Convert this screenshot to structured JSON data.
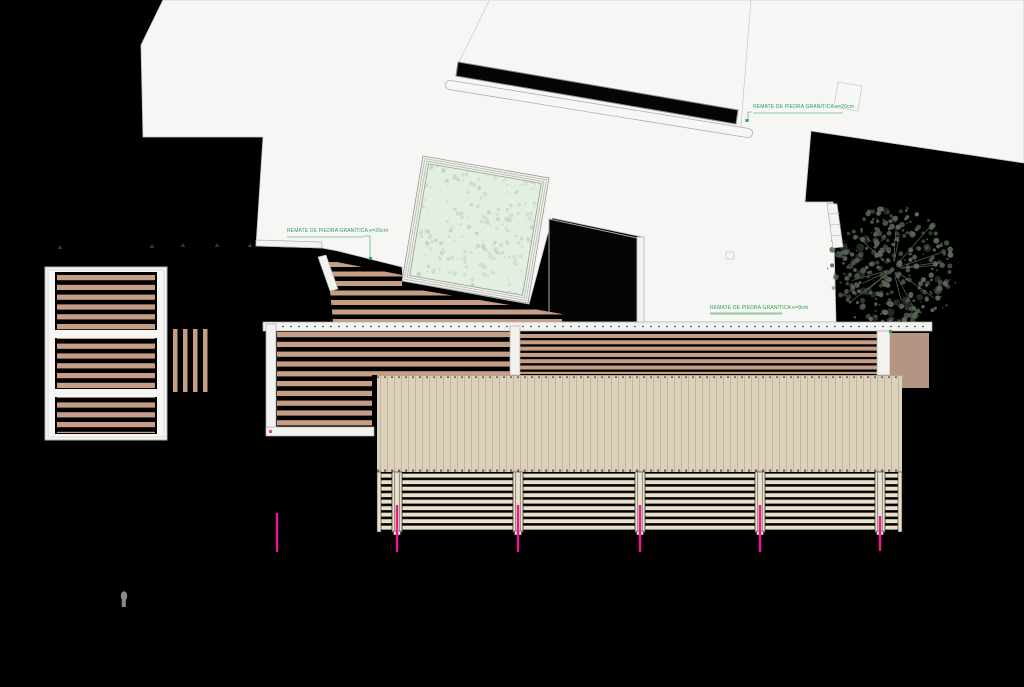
{
  "canvas": {
    "width": 1024,
    "height": 687,
    "background": "#000000"
  },
  "palette": {
    "paper": "#f6f6f4",
    "paper_line": "#c6c6c6",
    "line_dark": "#9a9a93",
    "plank": "#c69d85",
    "roof_base": "#ddd1bc",
    "roof_stripe": "#c3b59b",
    "roof_tick": "#6a6358",
    "louver": "#e9e1cc",
    "louver_line": "#35302a",
    "pool_frame": "#f0f0ea",
    "pool_ring": "#b0b0aa",
    "pool_water": "#e3efe2",
    "pool_speckle1": "#b9d2b6",
    "pool_speckle2": "#a6c4a3",
    "pool_edge": "#8ba08a",
    "tree": "#5a6a57",
    "annotation_green": "#2f9e4e",
    "section_pink": "#f01590",
    "solid_brown": "#b49483",
    "figure_gray": "#8a8a8a",
    "marker_dark": "#3a3a3a",
    "kerb_fill": "#f2f2ee",
    "kerb_line": "#b0b0b0",
    "void_black": "#050505"
  },
  "annotations": [
    {
      "text": "REMATE DE PIEDRA GRANÍTICA e=20cm",
      "x": 753,
      "y": 105
    },
    {
      "text": "REMATE DE PIEDRA GRANÍTICA e=20cm",
      "x": 287,
      "y": 229
    },
    {
      "text": "REMATE DE PIEDRA GRANÍTICA e=8cm",
      "x": 710,
      "y": 306
    }
  ],
  "terrain": {
    "points": [
      [
        163,
        0
      ],
      [
        1024,
        0
      ],
      [
        1024,
        163
      ],
      [
        811,
        131
      ],
      [
        805,
        202
      ],
      [
        833,
        202
      ],
      [
        836,
        322
      ],
      [
        643,
        322
      ],
      [
        643,
        237
      ],
      [
        552,
        218
      ],
      [
        529,
        304
      ],
      [
        403,
        281
      ],
      [
        402,
        267
      ],
      [
        338,
        251
      ],
      [
        322,
        248
      ],
      [
        256,
        246
      ],
      [
        263,
        137
      ],
      [
        143,
        137
      ],
      [
        141,
        45
      ]
    ]
  },
  "details": {
    "faint_lines": [
      [
        751,
        0,
        740,
        137
      ],
      [
        489,
        1,
        459,
        62
      ]
    ],
    "small_squares": [
      {
        "points": [
          [
            838,
            82
          ],
          [
            862,
            86
          ],
          [
            858,
            111
          ],
          [
            834,
            107
          ]
        ]
      },
      {
        "points": [
          [
            726,
            252
          ],
          [
            734,
            252
          ],
          [
            734,
            259
          ],
          [
            726,
            259
          ]
        ]
      }
    ],
    "stadium": {
      "x1": 450,
      "y1": 85,
      "x2": 748,
      "y2": 133
    }
  },
  "black_overlays": [
    {
      "name": "wall-band",
      "points": [
        [
          458,
          62
        ],
        [
          738,
          110
        ],
        [
          736,
          124
        ],
        [
          456,
          76
        ]
      ],
      "stroke": "#8a8a8a"
    },
    {
      "name": "pool-side-void",
      "points": [
        [
          549,
          219
        ],
        [
          637,
          238
        ],
        [
          637,
          322
        ],
        [
          549,
          322
        ]
      ],
      "stroke": "#aaaaaa"
    }
  ],
  "white_strips": [
    {
      "r": [
        45,
        267,
        122,
        173
      ],
      "inner": true
    }
  ],
  "deck_black_bases": [
    [
      55,
      272,
      102,
      162
    ],
    [
      263,
      322,
      252,
      114
    ],
    [
      515,
      322,
      380,
      53
    ]
  ],
  "plank_fields": [
    {
      "name": "left-deck",
      "clip": [
        [
          57,
          273
        ],
        [
          155,
          273
        ],
        [
          155,
          433
        ],
        [
          57,
          433
        ]
      ],
      "pitch": 9.8,
      "h": 5.2
    },
    {
      "name": "tilted-deck",
      "clip": [
        [
          327,
          260
        ],
        [
          402,
          275
        ],
        [
          402,
          287
        ],
        [
          528,
          308
        ],
        [
          562,
          314
        ],
        [
          562,
          322
        ],
        [
          333,
          322
        ]
      ],
      "pitch": 9.5,
      "h": 5.0
    },
    {
      "name": "middle-deck",
      "clip": [
        [
          277,
          330
        ],
        [
          512,
          330
        ],
        [
          512,
          375
        ],
        [
          372,
          375
        ],
        [
          372,
          427
        ],
        [
          277,
          427
        ]
      ],
      "pitch": 9.8,
      "h": 5.2
    },
    {
      "name": "right-deck",
      "clip": [
        [
          520,
          332
        ],
        [
          877,
          332
        ],
        [
          877,
          374
        ],
        [
          520,
          374
        ]
      ],
      "pitch": 6.3,
      "h": 4.0
    }
  ],
  "plank_dividers": [
    [
      55,
      330,
      102,
      8
    ],
    [
      55,
      389,
      102,
      8
    ]
  ],
  "vertical_planks": {
    "x0": 173,
    "step": 10,
    "count": 4,
    "w": 4.5,
    "y": 329,
    "h": 63
  },
  "kerbs": [
    {
      "type": "rect",
      "r": [
        263,
        322,
        669,
        9
      ],
      "dash": [
        266,
        930,
        326.5
      ]
    },
    {
      "type": "rect",
      "r": [
        637,
        237,
        7,
        85
      ]
    },
    {
      "type": "rect",
      "r": [
        266,
        324,
        10,
        108
      ]
    },
    {
      "type": "rect",
      "r": [
        266,
        427,
        108,
        9
      ]
    },
    {
      "type": "rect",
      "r": [
        510,
        326,
        10,
        49
      ]
    },
    {
      "type": "rect",
      "r": [
        877,
        331,
        13,
        44
      ]
    },
    {
      "type": "quad",
      "p": [
        [
          256,
          240
        ],
        [
          322,
          242
        ],
        [
          322,
          248
        ],
        [
          256,
          246
        ]
      ]
    },
    {
      "type": "quad",
      "p": [
        [
          318,
          257
        ],
        [
          326,
          255
        ],
        [
          338,
          289
        ],
        [
          330,
          291
        ]
      ]
    },
    {
      "type": "quad",
      "p": [
        [
          827,
          203
        ],
        [
          837,
          204
        ],
        [
          843,
          247
        ],
        [
          833,
          248
        ]
      ],
      "rungs": [
        [
          829,
          214,
          840,
          213
        ],
        [
          830,
          225,
          841,
          224
        ],
        [
          831,
          236,
          842,
          235
        ]
      ]
    }
  ],
  "solid_rect": [
    890,
    333,
    39,
    55
  ],
  "roof": {
    "rect": [
      377,
      375,
      525,
      97
    ],
    "stripe_step": 7
  },
  "louvers": {
    "top": 472,
    "rows": 9,
    "row_step": 6.5,
    "slat_h": 4.3,
    "slat_y0": 473.5,
    "segments": [
      [
        379,
        392
      ],
      [
        402,
        513
      ],
      [
        523,
        635
      ],
      [
        645,
        755
      ],
      [
        765,
        875
      ],
      [
        885,
        900
      ]
    ],
    "posts": [
      392,
      513,
      635,
      755,
      875
    ],
    "post_w": 10,
    "edge_posts": [
      377,
      898
    ],
    "edge_w": 4,
    "post_h": 60
  },
  "section_lines": [
    [
      277,
      513,
      552
    ],
    [
      397,
      505,
      552
    ],
    [
      518,
      505,
      552
    ],
    [
      640,
      505,
      552
    ],
    [
      760,
      505,
      552
    ],
    [
      880,
      516,
      551
    ]
  ],
  "pink_dot": [
    269,
    430,
    3,
    3
  ],
  "triangles": [
    [
      60,
      247
    ],
    [
      152,
      246
    ],
    [
      183,
      245
    ],
    [
      217,
      245
    ],
    [
      250,
      245
    ]
  ],
  "green": {
    "markers": [
      [
        745.5,
        119
      ],
      [
        369,
        257
      ],
      [
        889,
        330
      ]
    ],
    "leaders": [
      [
        [
          752,
          112
        ],
        [
          748,
          112
        ],
        [
          748,
          119
        ]
      ],
      [
        [
          363,
          236
        ],
        [
          370,
          236
        ],
        [
          370,
          257
        ]
      ],
      [
        [
          710,
          313
        ],
        [
          782,
          313
        ]
      ]
    ],
    "underlines": [
      [
        753,
        113,
        843
      ],
      [
        287,
        237,
        363
      ],
      [
        710,
        314,
        782
      ]
    ]
  },
  "figure": {
    "x": 124,
    "y": 596
  },
  "pool": {
    "outer": [
      [
        423,
        156
      ],
      [
        549,
        178
      ],
      [
        528,
        303
      ],
      [
        402,
        281
      ]
    ],
    "rings": [
      0.035,
      0.07
    ],
    "water_inset": 0.105,
    "speckle": {
      "n": 300,
      "seed": 11
    }
  },
  "tree": {
    "cx": 893,
    "cy": 269,
    "r": 64,
    "seed": 7,
    "blobs": 320,
    "twigs": 14
  }
}
